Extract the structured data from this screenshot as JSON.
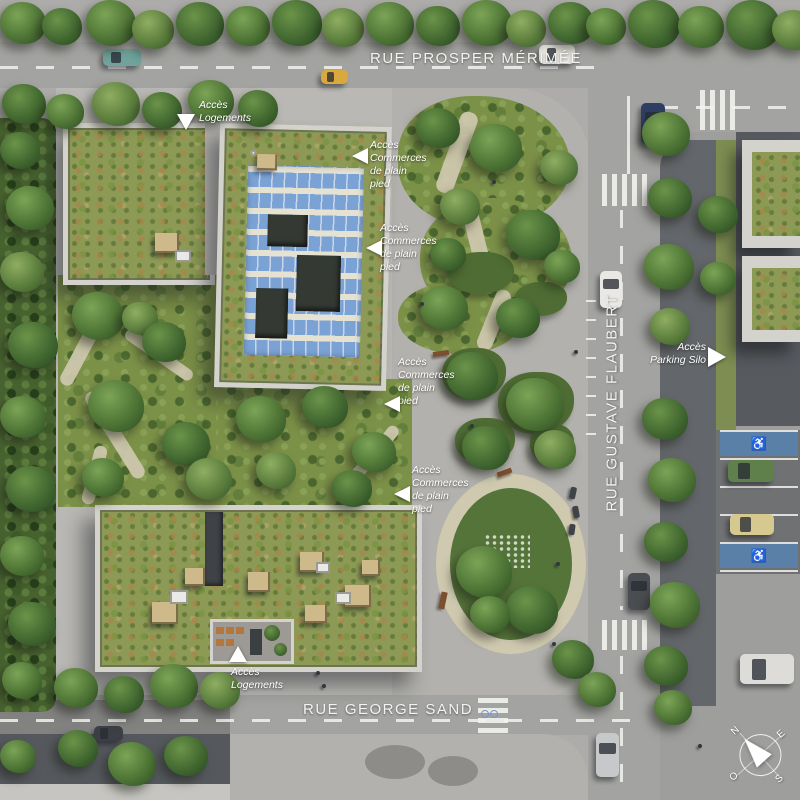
{
  "scene": {
    "description": "Aerial architectural site plan (plan masse) with landscaped block, central park and street network"
  },
  "streets": {
    "prosper_merimee": "RUE PROSPER MÉRIMÉE",
    "gustave_flaubert": "RUE GUSTAVE FLAUBERT",
    "george_sand": "RUE GEORGE SAND"
  },
  "annotations": {
    "acces_logements": {
      "line1": "Accès",
      "line2": "Logements"
    },
    "acces_commerces": {
      "line1": "Accès",
      "line2": "Commerces",
      "line3": "de plain",
      "line4": "pied"
    },
    "acces_parking": {
      "line1": "Accès",
      "line2": "Parking Silo"
    }
  },
  "compass": {
    "north": "N",
    "east": "E",
    "south": "S",
    "west": "O"
  },
  "icons": {
    "disabled_parking": "♿"
  },
  "colors": {
    "road": "#a3a3a1",
    "road_dark": "#63666a",
    "plaza": "#b2b1ad",
    "sidewalk": "#b9b8b4",
    "right_zone": "#9e9e9c",
    "concrete_dark": "#575b60",
    "parking": "#6f7173",
    "marking": "#f2f2ef",
    "parapet": "#d3d2cc",
    "sedum": "#8d9a55",
    "garden": "#7c9148",
    "lawn_dark": "#55743a",
    "gravel": "#cfc9b0",
    "hedge": "#47622f",
    "solar": "#7aa2d4",
    "solar_gap": "#c9d6ea",
    "solar_walk": "#e6e2d2",
    "disabled_blue": "#5b80a8",
    "label_white": "#ffffff"
  }
}
